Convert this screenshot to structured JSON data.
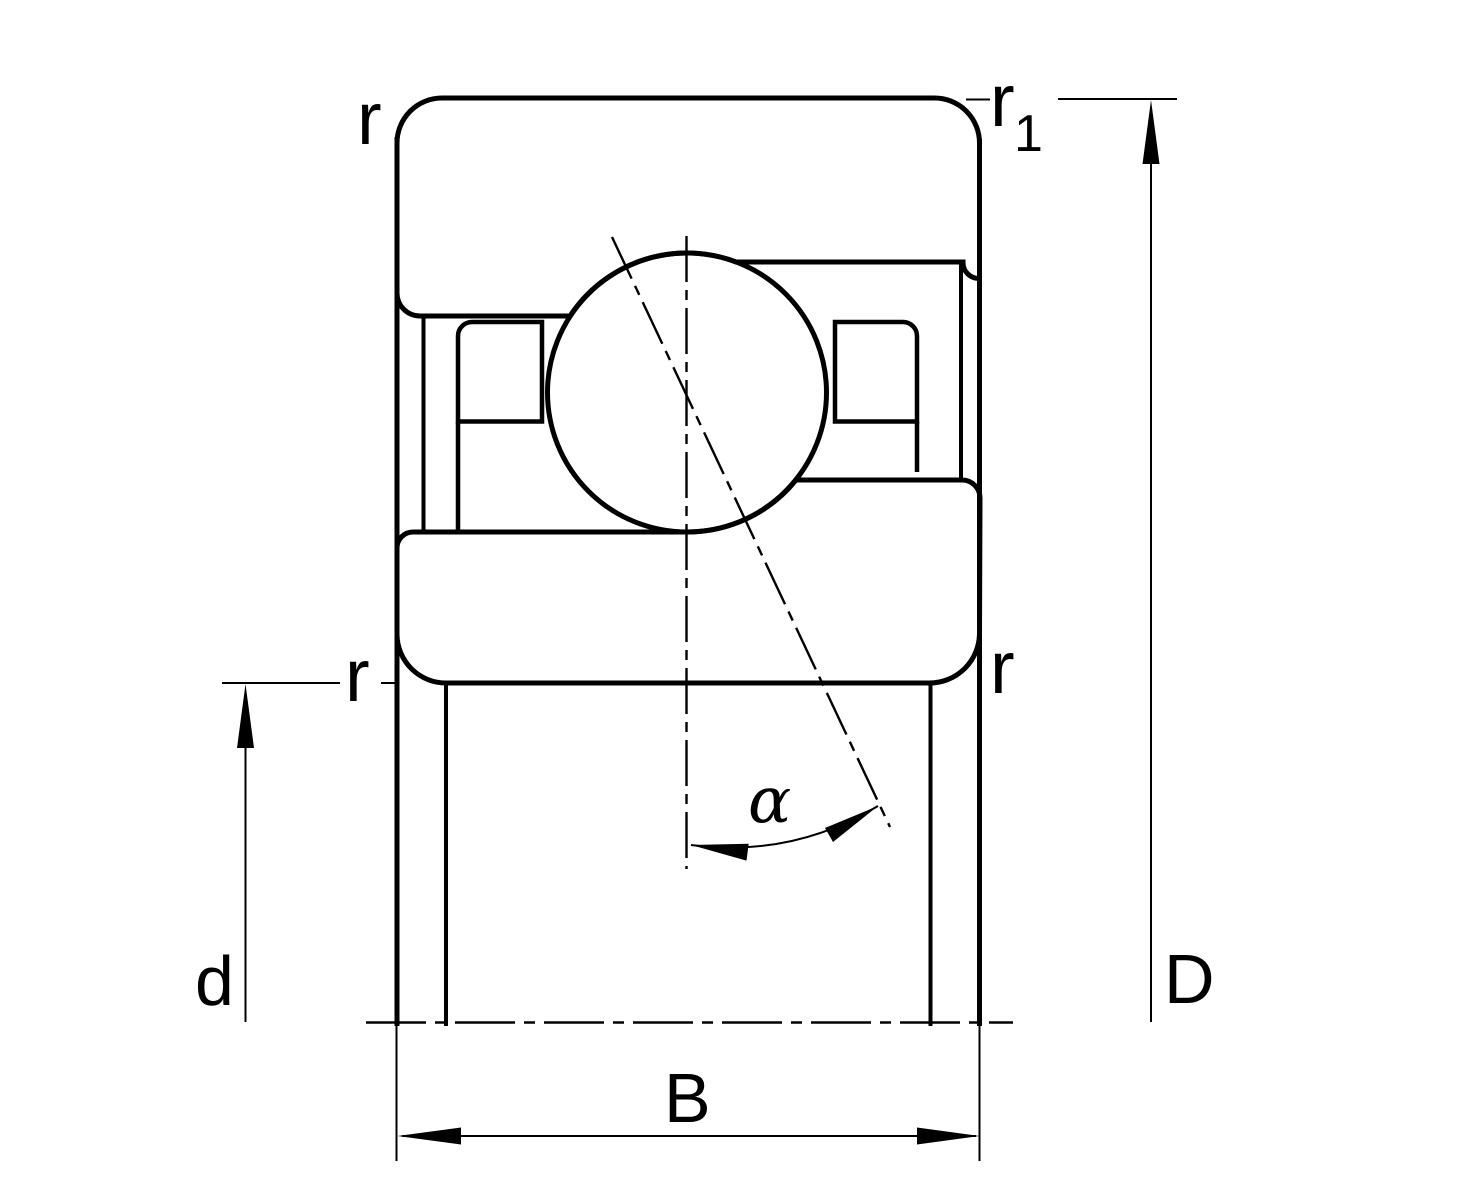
{
  "page": {
    "background_color": "#ffffff"
  },
  "diagram": {
    "stroke_color": "#000000",
    "labels": {
      "chamfer_radius_top_left": "r",
      "chamfer_radius_top_right_main": "r",
      "chamfer_radius_top_right_sub": "1",
      "chamfer_radius_bottom_left": "r",
      "chamfer_radius_bottom_right": "r",
      "bore_diameter": "d",
      "outside_diameter": "D",
      "width": "B",
      "contact_angle": "α"
    }
  }
}
